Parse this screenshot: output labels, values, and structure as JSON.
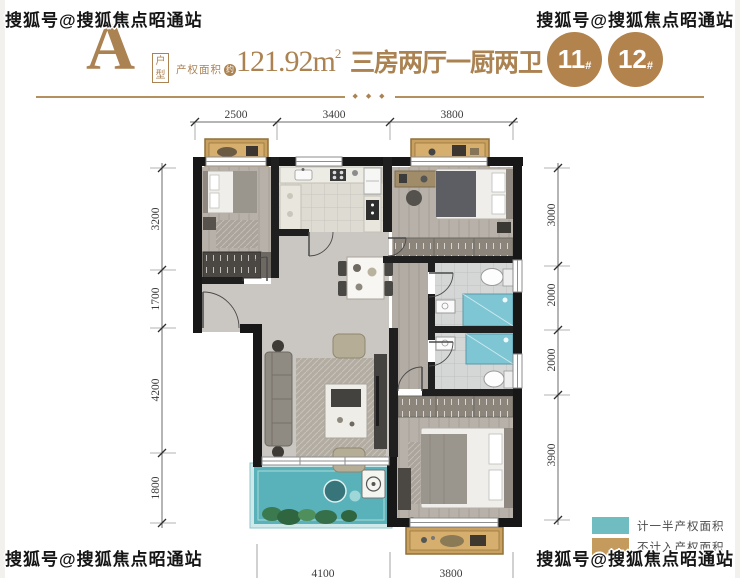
{
  "watermark": {
    "text": "搜狐号@搜狐焦点昭通站"
  },
  "header": {
    "unit_letter": "A",
    "unit_tag": "户型",
    "area_label": "产权面积",
    "area_approx_badge": "约",
    "area_value": "121.92m",
    "area_superscript": "2",
    "rooms_title": "三房两厅一厨两卫",
    "divider_ornament": "◆ ◆ ◆",
    "buildings": [
      {
        "number": "11",
        "suffix": "#"
      },
      {
        "number": "12",
        "suffix": "#"
      }
    ]
  },
  "dimensions": {
    "top": [
      "2500",
      "3400",
      "3800"
    ],
    "left": [
      "3200",
      "1700",
      "4200",
      "1800"
    ],
    "right": [
      "3000",
      "2000",
      "2000",
      "3900"
    ],
    "bottom": [
      "4100",
      "3800"
    ]
  },
  "legend": {
    "items": [
      {
        "label": "计一半产权面积",
        "color": "#6fbcc1"
      },
      {
        "label": "不计入产权面积",
        "color": "#c59a5d"
      }
    ]
  },
  "colors": {
    "accent_gold": "#ab8251",
    "balcony_teal": "#59b2b9",
    "bay_window_tan": "#c9a05f",
    "wall": "#171717"
  }
}
